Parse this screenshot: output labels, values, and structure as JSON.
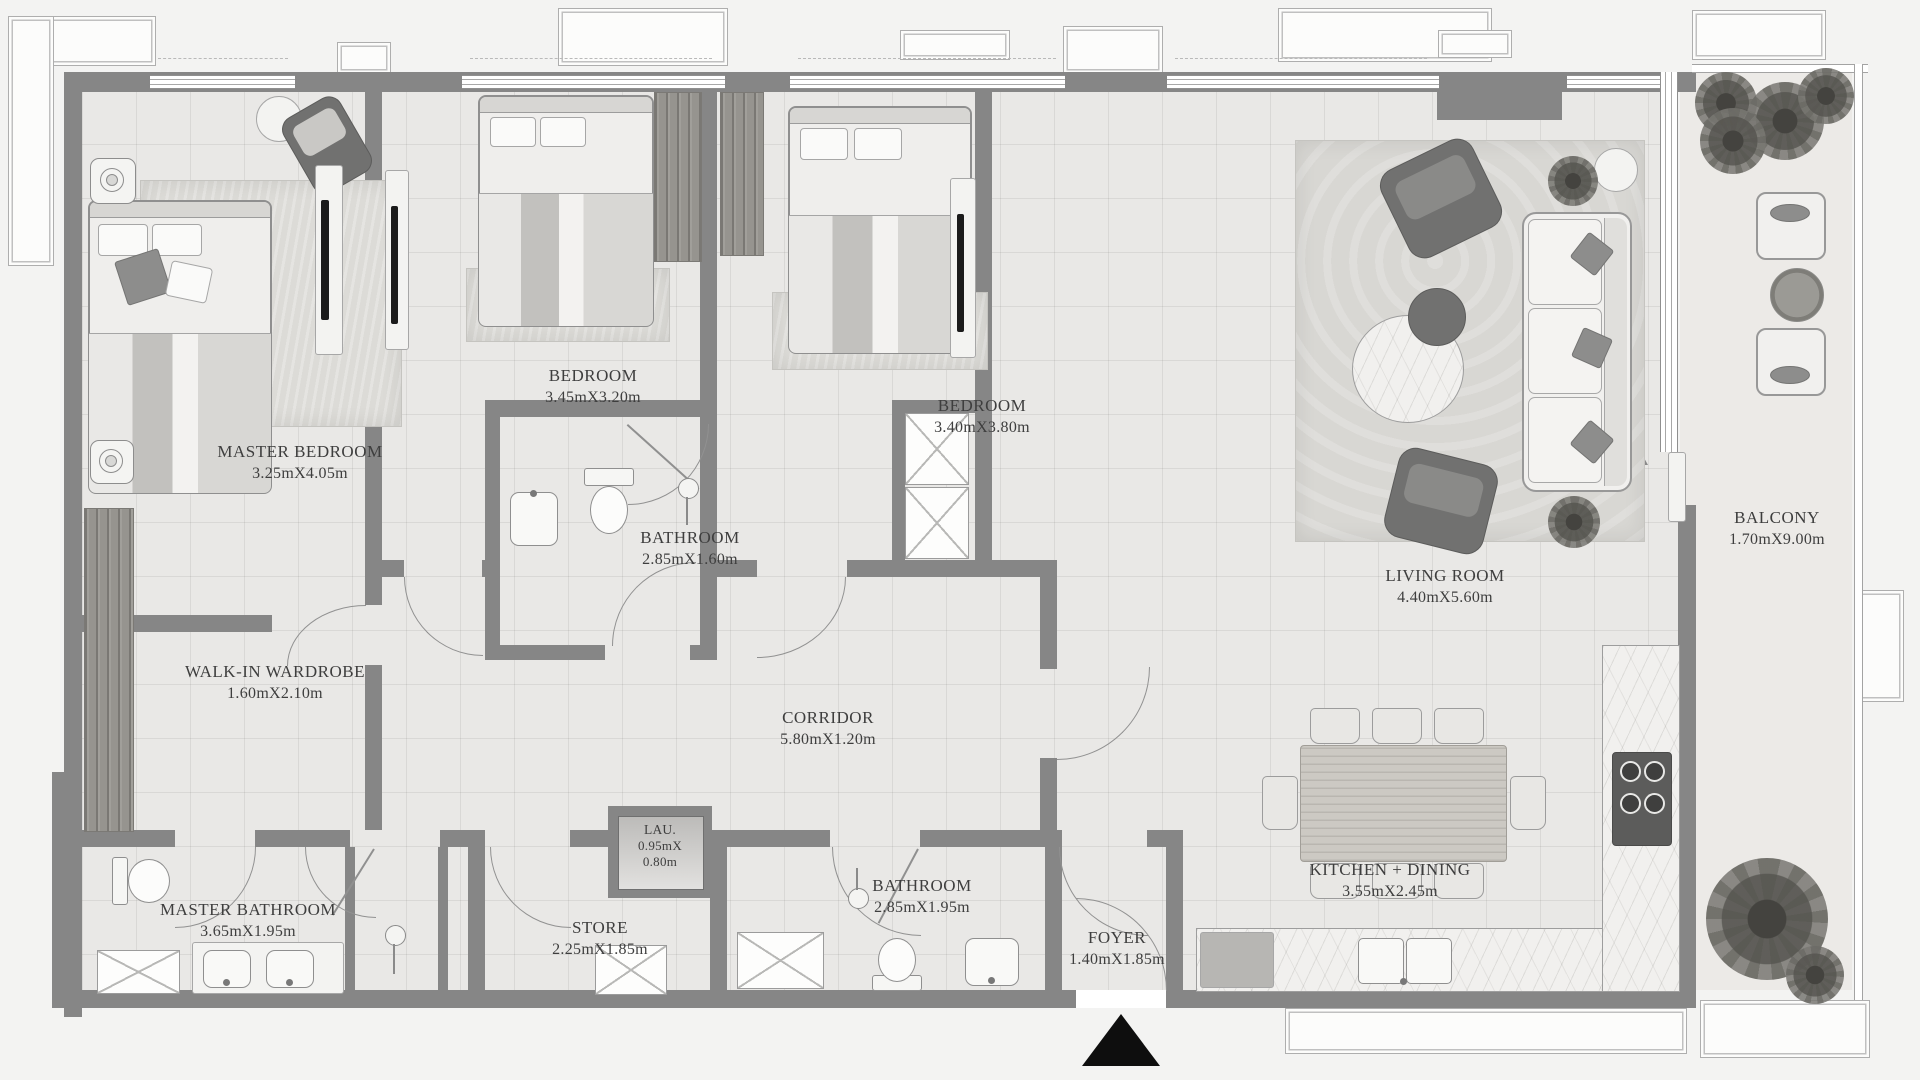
{
  "rooms": [
    {
      "id": "master-bedroom",
      "label": "MASTER BEDROOM",
      "dims": "3.25mX4.05m"
    },
    {
      "id": "bedroom-1",
      "label": "BEDROOM",
      "dims": "3.45mX3.20m"
    },
    {
      "id": "bedroom-2",
      "label": "BEDROOM",
      "dims": "3.40mX3.80m"
    },
    {
      "id": "bathroom-1",
      "label": "BATHROOM",
      "dims": "2.85mX1.60m"
    },
    {
      "id": "living-room",
      "label": "LIVING ROOM",
      "dims": "4.40mX5.60m"
    },
    {
      "id": "balcony",
      "label": "BALCONY",
      "dims": "1.70mX9.00m"
    },
    {
      "id": "walk-in-wardrobe",
      "label": "WALK-IN WARDROBE",
      "dims": "1.60mX2.10m"
    },
    {
      "id": "corridor",
      "label": "CORRIDOR",
      "dims": "5.80mX1.20m"
    },
    {
      "id": "master-bathroom",
      "label": "MASTER BATHROOM",
      "dims": "3.65mX1.95m"
    },
    {
      "id": "laundry",
      "label": "LAU.",
      "dims_l1": "0.95mX",
      "dims_l2": "0.80m"
    },
    {
      "id": "store",
      "label": "STORE",
      "dims": "2.25mX1.85m"
    },
    {
      "id": "bathroom-2",
      "label": "BATHROOM",
      "dims": "2.85mX1.95m"
    },
    {
      "id": "foyer",
      "label": "FOYER",
      "dims": "1.40mX1.85m"
    },
    {
      "id": "kitchen-dining",
      "label": "KITCHEN + DINING",
      "dims": "3.55mX2.45m"
    }
  ],
  "entrance": {
    "marker": "entrance-arrow"
  },
  "colors": {
    "wall": "#868686",
    "floor": "#e9e8e6",
    "label_text": "#3e3e3e",
    "furniture_dark": "#717170",
    "entrance_marker": "#0e0e0e"
  }
}
